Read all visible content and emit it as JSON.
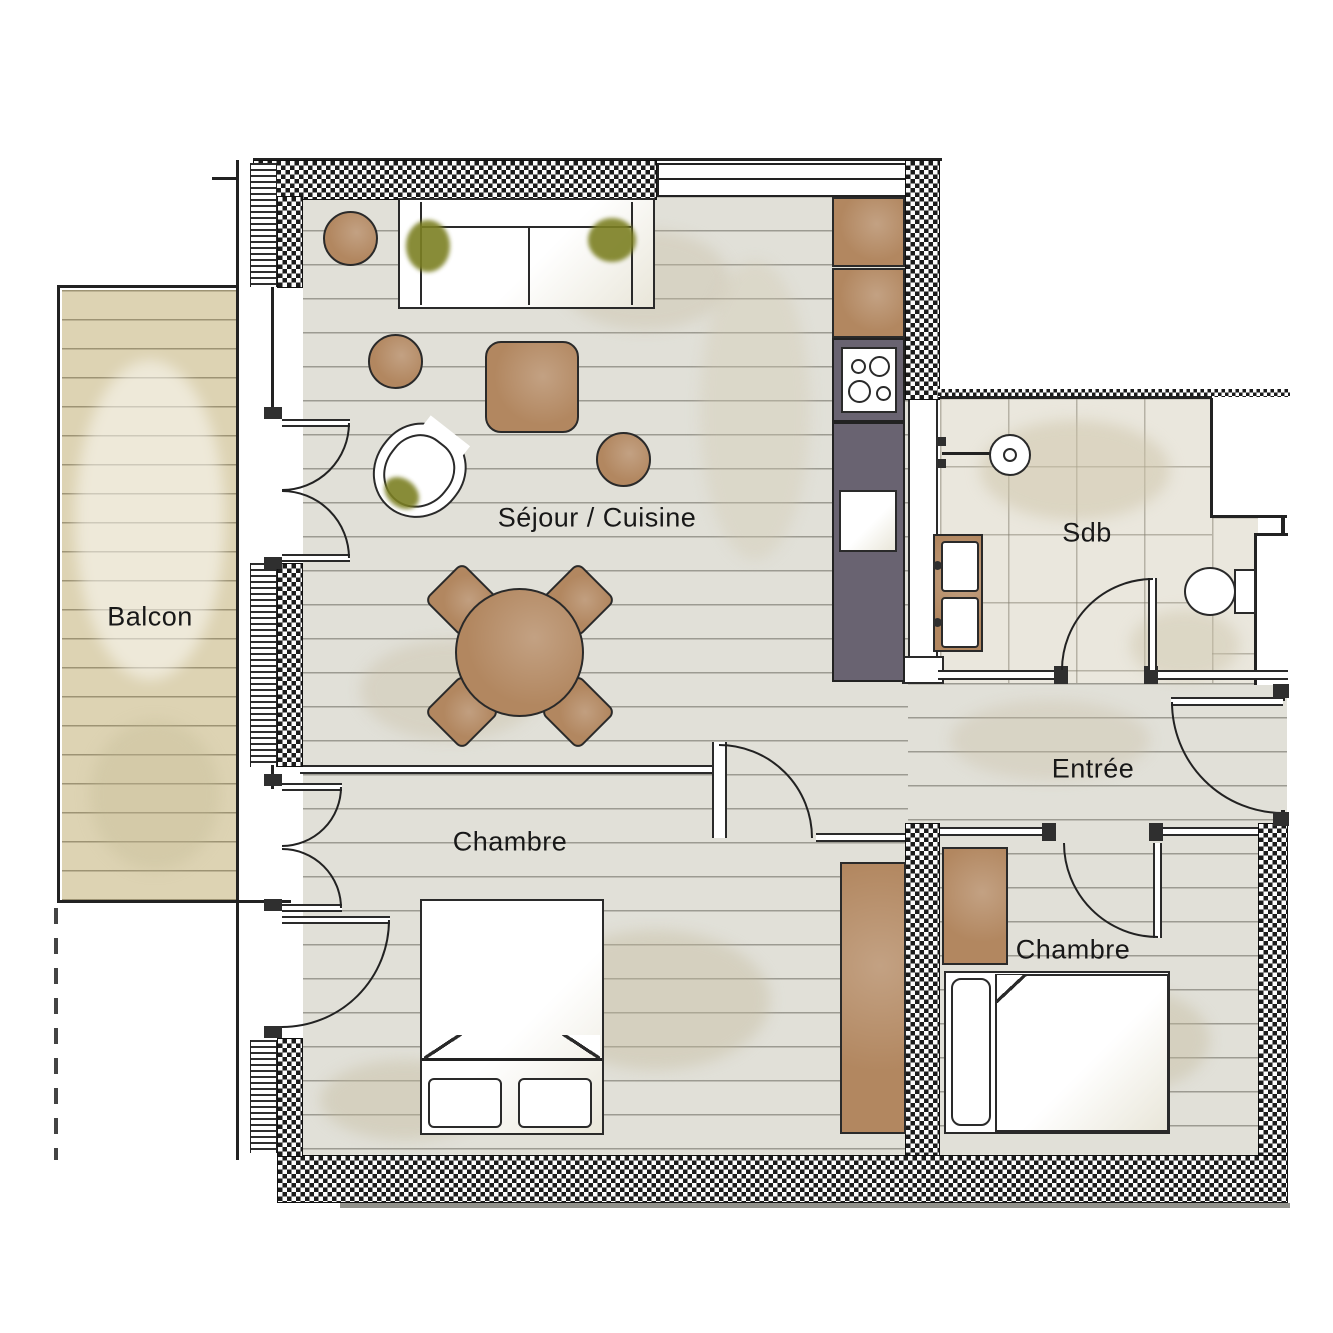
{
  "rooms": {
    "balcony": {
      "label": "Balcon"
    },
    "living_kitchen": {
      "label": "Séjour / Cuisine"
    },
    "bathroom": {
      "label": "Sdb"
    },
    "entry_hall": {
      "label": "Entrée"
    },
    "bedroom_left": {
      "label": "Chambre"
    },
    "bedroom_right": {
      "label": "Chambre"
    }
  },
  "colors": {
    "wood_floor": "#e1e0d8",
    "balcony_deck": "#ddd3b3",
    "tile_floor": "#eae7dd",
    "furniture_brown": "#b28760",
    "counter_gray": "#696371",
    "plant_green": "#7c8023",
    "wall_dark": "#1a1a1a"
  }
}
